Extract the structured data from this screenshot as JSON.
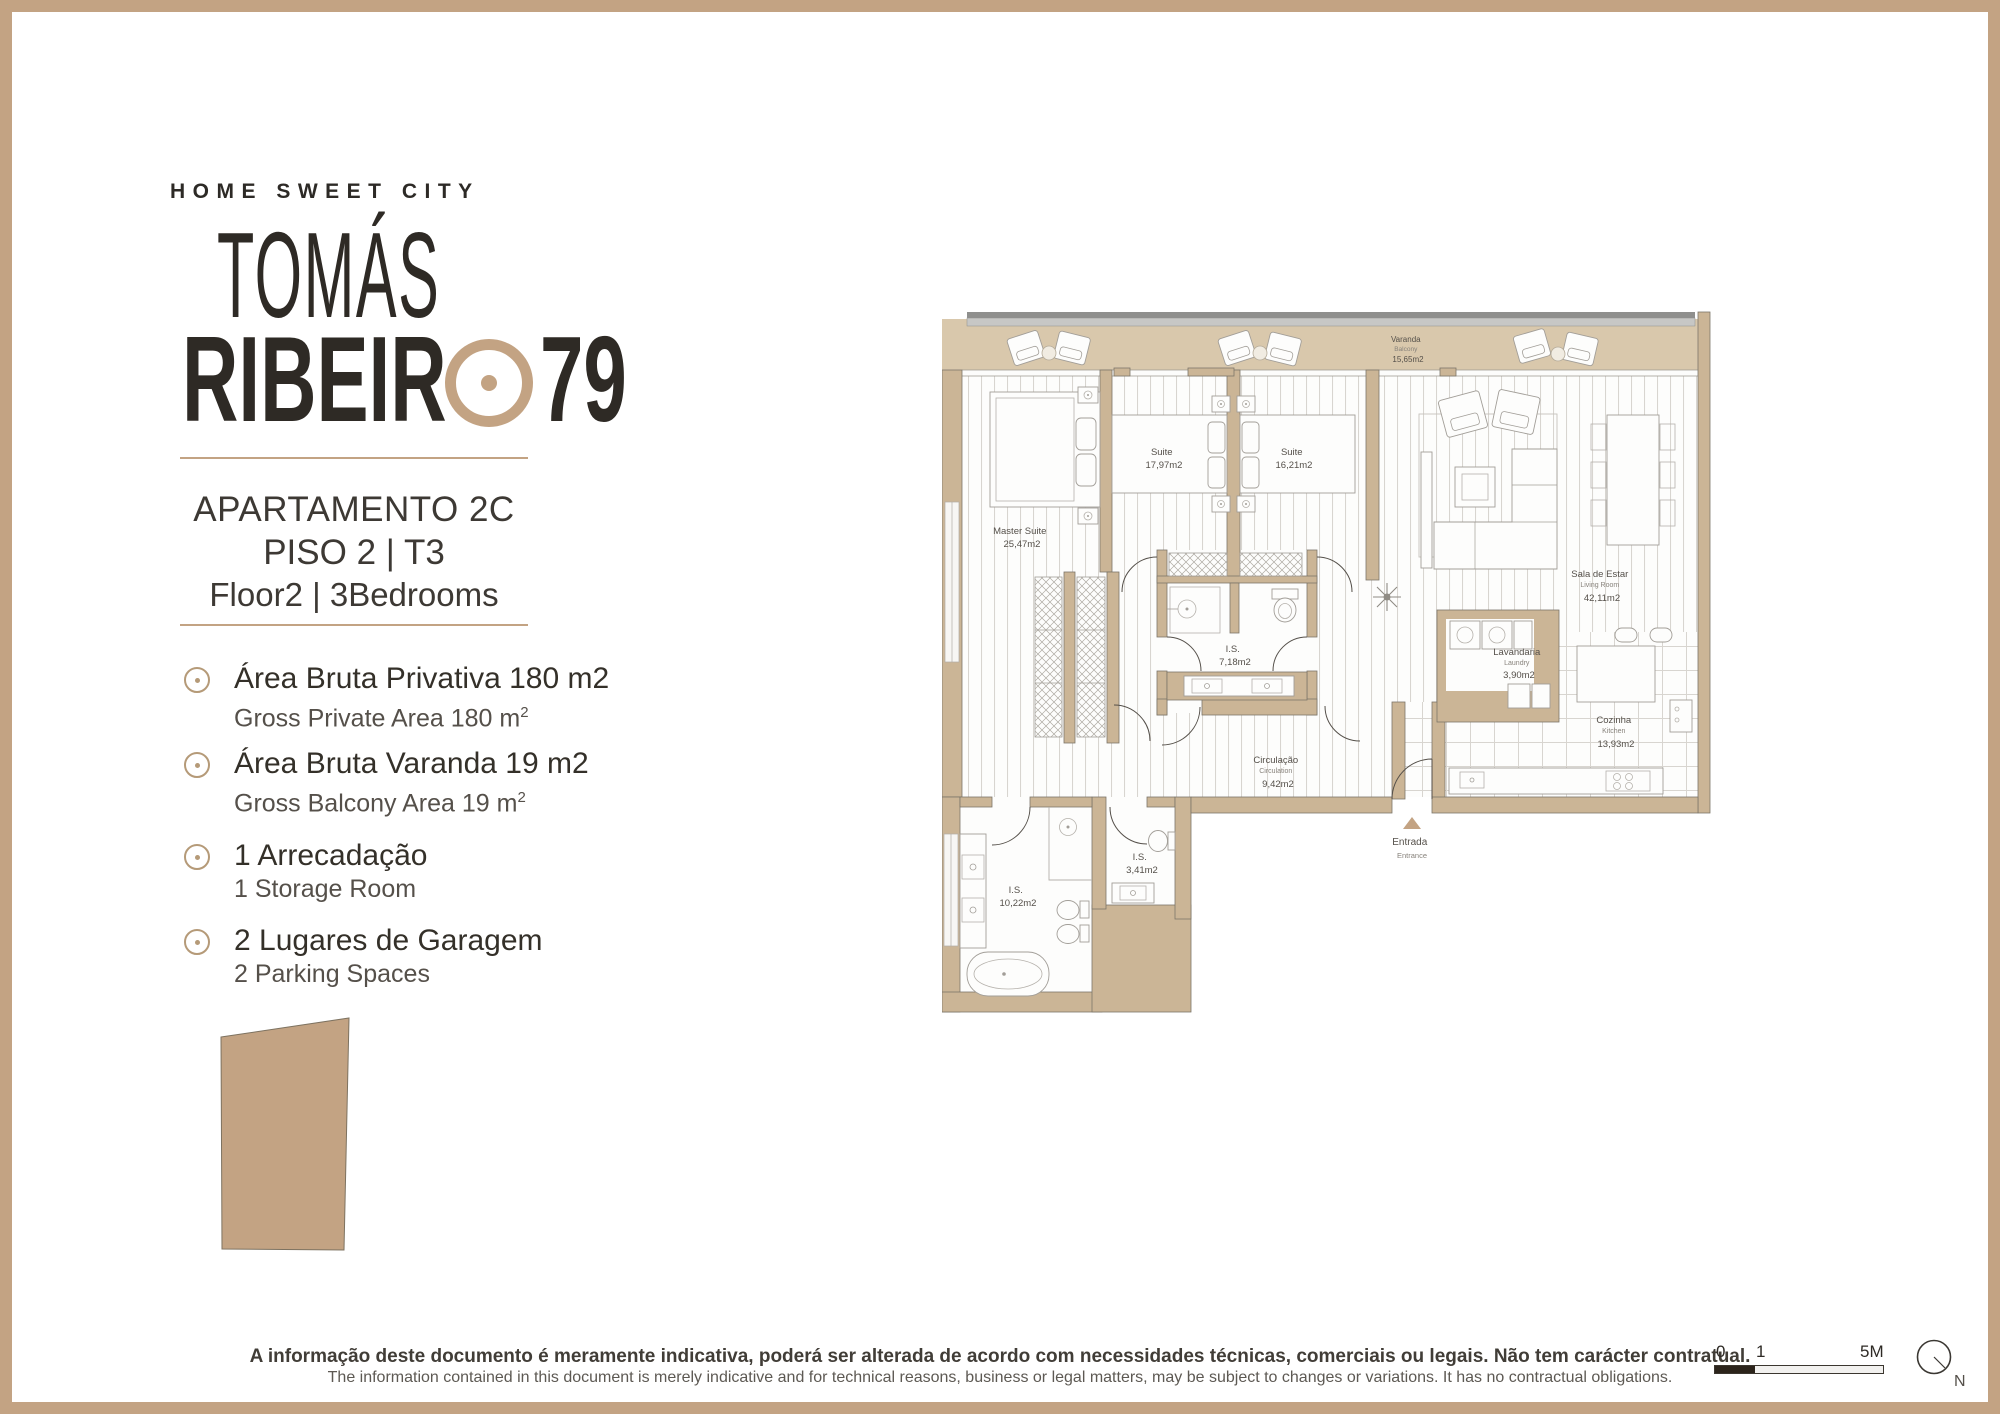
{
  "colors": {
    "accent": "#c3a383",
    "wall": "#cbb596",
    "balcony_floor": "#d9c8ac"
  },
  "brand": {
    "tagline": "HOME SWEET CITY",
    "title_line1": "TOMÁS",
    "title_line2_left": "RIBEIR",
    "title_line2_right": "79"
  },
  "apartment": {
    "line1": "APARTAMENTO 2C",
    "line2": "PISO 2 | T3",
    "line3": "Floor2 | 3Bedrooms"
  },
  "features": [
    {
      "pt": "Área Bruta Privativa 180 m2",
      "en": "Gross Private Area 180 m",
      "sup": "2"
    },
    {
      "pt": "Área Bruta Varanda 19 m2",
      "en": "Gross Balcony Area 19 m",
      "sup": "2"
    },
    {
      "pt": "1 Arrecadação",
      "en": "1 Storage Room"
    },
    {
      "pt": "2 Lugares de Garagem",
      "en": "2 Parking Spaces"
    }
  ],
  "floorplan": {
    "rooms": {
      "varanda": {
        "pt": "Varanda",
        "en": "Balcony",
        "area": "15,65m2"
      },
      "master": {
        "pt": "Master Suite",
        "area": "25,47m2"
      },
      "suite1": {
        "pt": "Suite",
        "area": "17,97m2"
      },
      "suite2": {
        "pt": "Suite",
        "area": "16,21m2"
      },
      "sala": {
        "pt": "Sala de Estar",
        "en": "Living Room",
        "area": "42,11m2"
      },
      "is_central": {
        "pt": "I.S.",
        "area": "7,18m2"
      },
      "circulacao": {
        "pt": "Circulação",
        "en": "Circulation",
        "area": "9,42m2"
      },
      "is_small": {
        "pt": "I.S.",
        "area": "3,41m2"
      },
      "is_master": {
        "pt": "I.S.",
        "area": "10,22m2"
      },
      "lavandaria": {
        "pt": "Lavandaria",
        "en": "Laundry",
        "area": "3,90m2"
      },
      "cozinha": {
        "pt": "Cozinha",
        "en": "Kitchen",
        "area": "13,93m2"
      },
      "entrada": {
        "pt": "Entrada",
        "en": "Entrance"
      }
    }
  },
  "footer": {
    "disclaimer_pt": "A informação deste documento é meramente indicativa, poderá ser alterada de acordo com necessidades técnicas, comerciais ou legais. Não tem carácter contratual.",
    "disclaimer_en": "The information contained in this document is merely indicative and for technical reasons, business or legal matters, may be subject to changes or variations. It has no contractual obligations.",
    "scalebar": {
      "t0": "0",
      "t1": "1",
      "t5": "5M"
    },
    "compass": "N"
  }
}
